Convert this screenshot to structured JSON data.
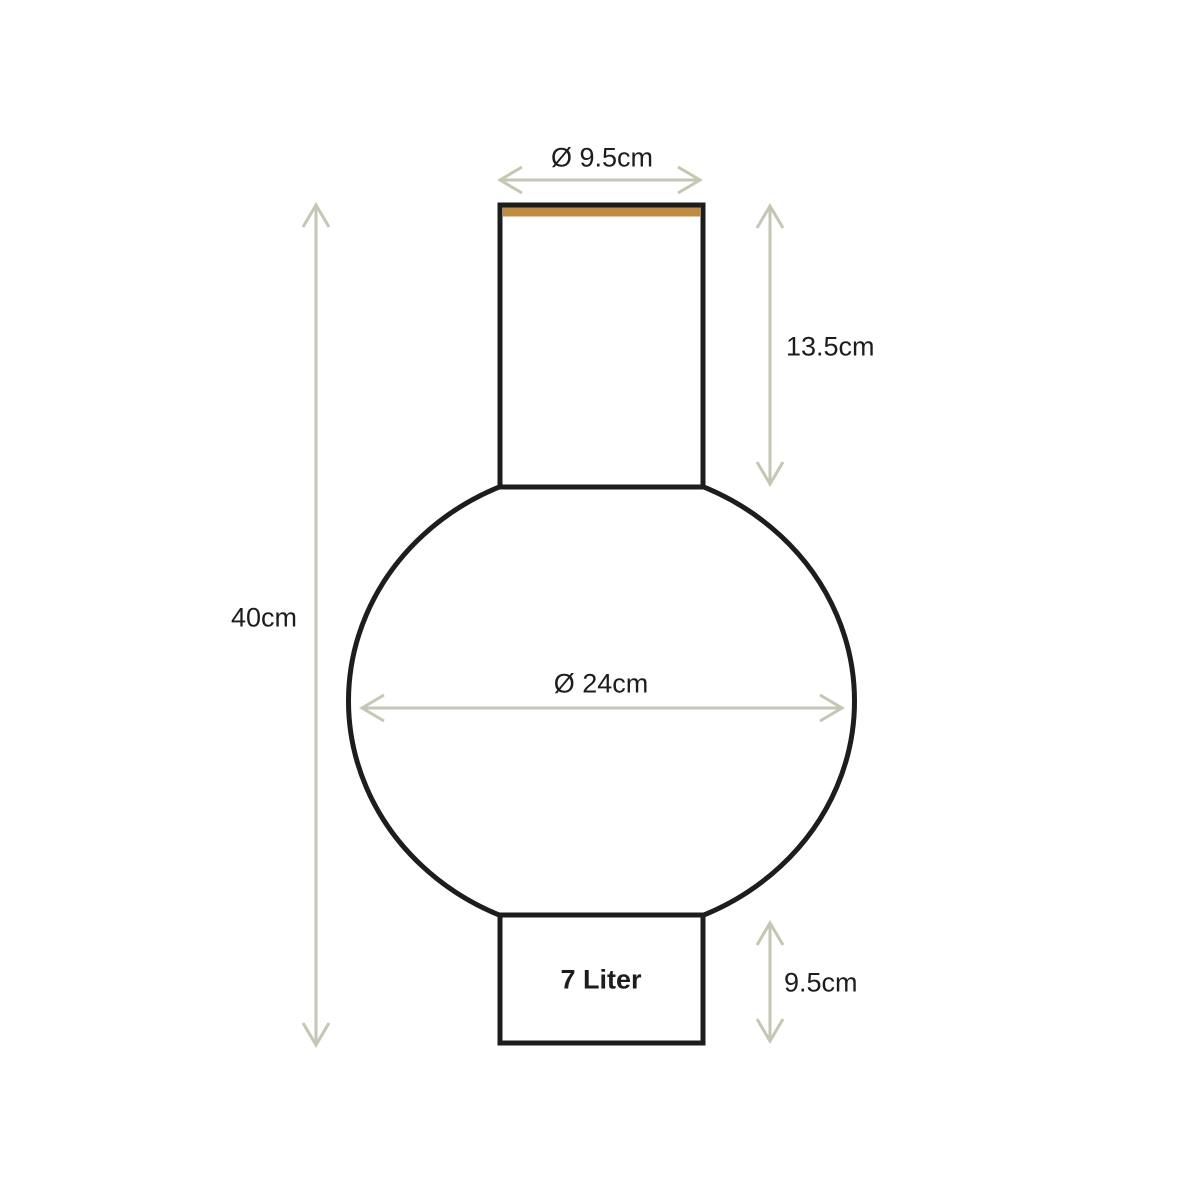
{
  "colors": {
    "background": "#ffffff",
    "outline": "#1d1d1b",
    "arrow": "#c5c6b4",
    "rim-accent": "#bf8c42",
    "text": "#1d1d1b"
  },
  "labels": {
    "top_diameter": "Ø 9.5cm",
    "neck_height": "13.5cm",
    "total_height": "40cm",
    "body_diameter": "Ø 24cm",
    "base_height": "9.5cm",
    "volume": "7 Liter"
  }
}
